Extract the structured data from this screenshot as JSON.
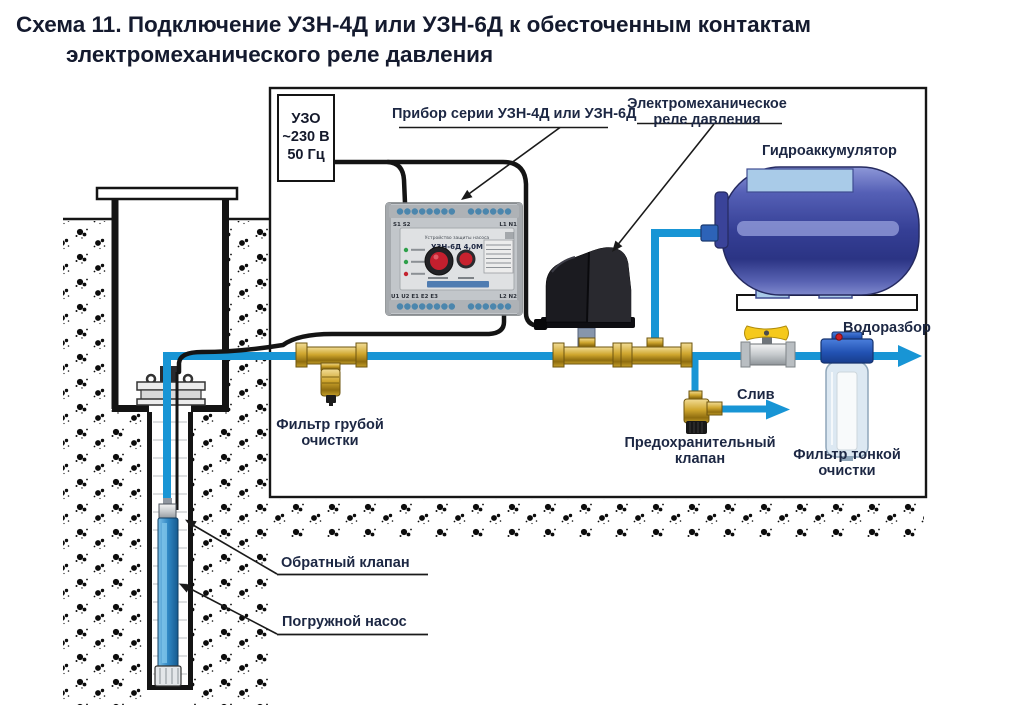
{
  "title": {
    "line1": "Схема 11. Подключение УЗН-4Д или УЗН-6Д к обесточенным контактам",
    "line2": "электромеханического реле давления"
  },
  "uzo_box": {
    "line1": "УЗО",
    "line2": "~230 В",
    "line3": "50 Гц"
  },
  "labels": {
    "device_pointer": "Прибор серии УЗН-4Д или УЗН-6Д",
    "pressure_relay_line1": "Электромеханическое",
    "pressure_relay_line2": "реле давления",
    "accumulator": "Гидроаккумулятор",
    "water_outlet": "Водоразбор",
    "coarse_filter_line1": "Фильтр грубой",
    "coarse_filter_line2": "очистки",
    "drain": "Слив",
    "safety_valve_line1": "Предохранительный",
    "safety_valve_line2": "клапан",
    "fine_filter_line1": "Фильтр тонкой",
    "fine_filter_line2": "очистки",
    "check_valve": "Обратный клапан",
    "pump": "Погружной насос"
  },
  "device": {
    "top_left_terminals": "S1 S2",
    "top_right_terminals": "L1  N1",
    "panel_caption": "Устройство защиты насоса",
    "model": "УЗН-6Д 4,0М",
    "bottom_left_terminals": "U1 U2  E1 E2 E3",
    "bottom_right_terminals": "L2  N2"
  },
  "colors": {
    "pipe_blue": "#1895d5",
    "cable_black": "#141414",
    "brass": "#d7af37",
    "tank_blue": "#353f95",
    "tank_plate_blue": "#a9cbe8",
    "pump_blue": "#2f87c4",
    "valve_handle_yellow": "#f5c91c",
    "filter_head_blue": "#2353b4",
    "label_text": "#1c2743"
  }
}
